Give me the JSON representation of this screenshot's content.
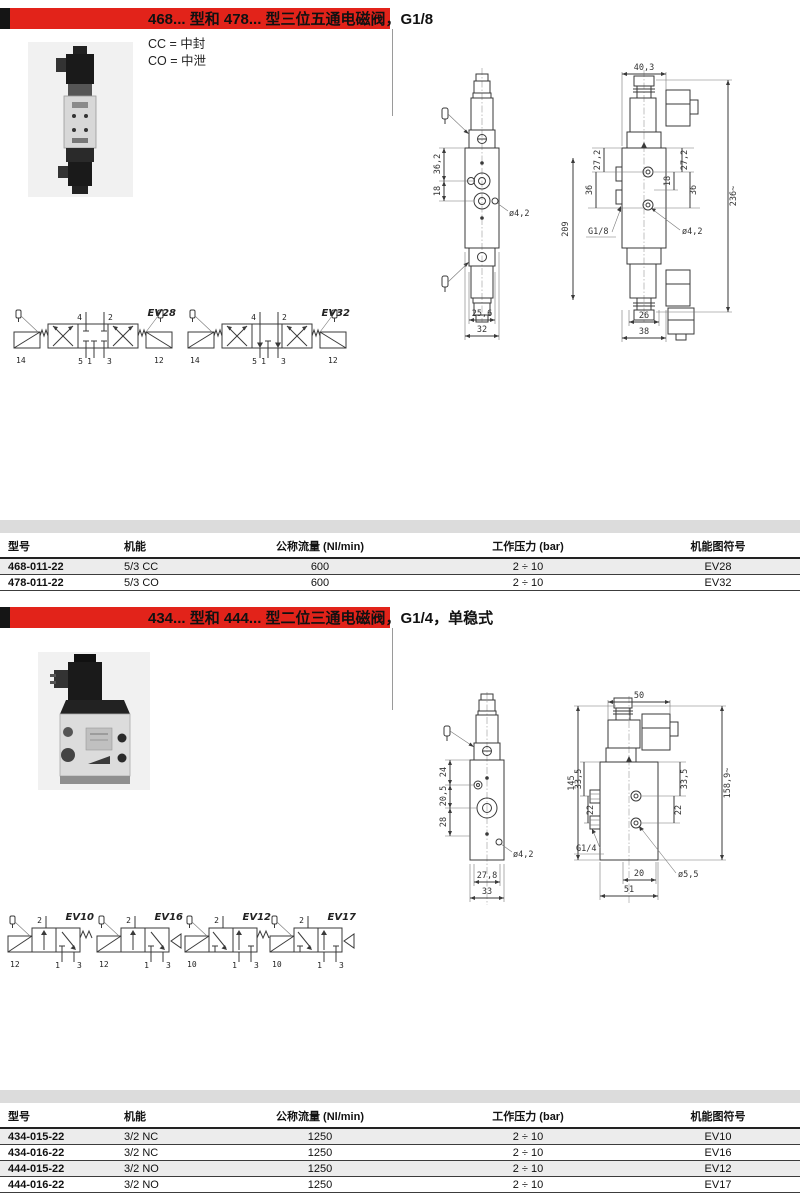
{
  "colors": {
    "accent_red": "#e2231a",
    "table_band": "#dcdcdc",
    "row_alt": "#ececec"
  },
  "section1": {
    "title": "468... 型和 478... 型三位五通电磁阀，G1/8",
    "legend_cc": "CC = 中封",
    "legend_co": "CO = 中泄",
    "drawing": {
      "front": {
        "dim_v1": "36,2",
        "dim_v2": "18",
        "hole": "ø4,2",
        "dim_w_inner": "25,6",
        "dim_w_outer": "32"
      },
      "side": {
        "dim_w_top": "40,3",
        "dim_h_body": "209",
        "dim_l1": "27,2",
        "dim_l2": "36",
        "dim_r1": "27,2",
        "dim_r2": "36",
        "dim_r3": "18",
        "port": "G1/8",
        "hole": "ø4,2",
        "dim_h_total": "236~",
        "dim_w_inner": "26",
        "dim_w_outer": "38"
      }
    },
    "symbols": [
      {
        "name": "EV28",
        "t1": "4",
        "t2": "2",
        "b1": "14",
        "b2": "5",
        "b3": "1",
        "b4": "3",
        "b5": "12"
      },
      {
        "name": "EV32",
        "t1": "4",
        "t2": "2",
        "b1": "14",
        "b2": "5",
        "b3": "1",
        "b4": "3",
        "b5": "12"
      }
    ],
    "table": {
      "headers": [
        "型号",
        "机能",
        "公称流量 (Nl/min)",
        "工作压力 (bar)",
        "机能图符号"
      ],
      "rows": [
        [
          "468-011-22",
          "5/3 CC",
          "600",
          "2 ÷ 10",
          "EV28"
        ],
        [
          "478-011-22",
          "5/3 CO",
          "600",
          "2 ÷ 10",
          "EV32"
        ]
      ]
    }
  },
  "section2": {
    "title": "434... 型和 444... 型二位三通电磁阀，G1/4，单稳式",
    "drawing": {
      "front": {
        "dim_v1": "24",
        "dim_v2": "20,5",
        "dim_v3": "28",
        "hole": "ø4,2",
        "dim_w_inner": "27,8",
        "dim_w_outer": "33"
      },
      "side": {
        "dim_w_top": "50",
        "dim_h_body": "145",
        "dim_l1": "33,5",
        "dim_l2": "22",
        "dim_r1": "33,5",
        "dim_r2": "22",
        "port": "G1/4",
        "hole": "ø5,5",
        "dim_h_total": "158,9~",
        "dim_w_inner": "20",
        "dim_w_outer": "51"
      }
    },
    "symbols": [
      {
        "name": "EV10",
        "t1": "2",
        "b1": "12",
        "b2": "1",
        "b3": "3"
      },
      {
        "name": "EV16",
        "t1": "2",
        "b1": "12",
        "b2": "1",
        "b3": "3"
      },
      {
        "name": "EV12",
        "t1": "2",
        "b1": "10",
        "b2": "1",
        "b3": "3"
      },
      {
        "name": "EV17",
        "t1": "2",
        "b1": "10",
        "b2": "1",
        "b3": "3"
      }
    ],
    "table": {
      "headers": [
        "型号",
        "机能",
        "公称流量 (Nl/min)",
        "工作压力 (bar)",
        "机能图符号"
      ],
      "rows": [
        [
          "434-015-22",
          "3/2 NC",
          "1250",
          "2 ÷ 10",
          "EV10"
        ],
        [
          "434-016-22",
          "3/2 NC",
          "1250",
          "2 ÷ 10",
          "EV16"
        ],
        [
          "444-015-22",
          "3/2 NO",
          "1250",
          "2 ÷ 10",
          "EV12"
        ],
        [
          "444-016-22",
          "3/2 NO",
          "1250",
          "2 ÷ 10",
          "EV17"
        ]
      ]
    }
  }
}
